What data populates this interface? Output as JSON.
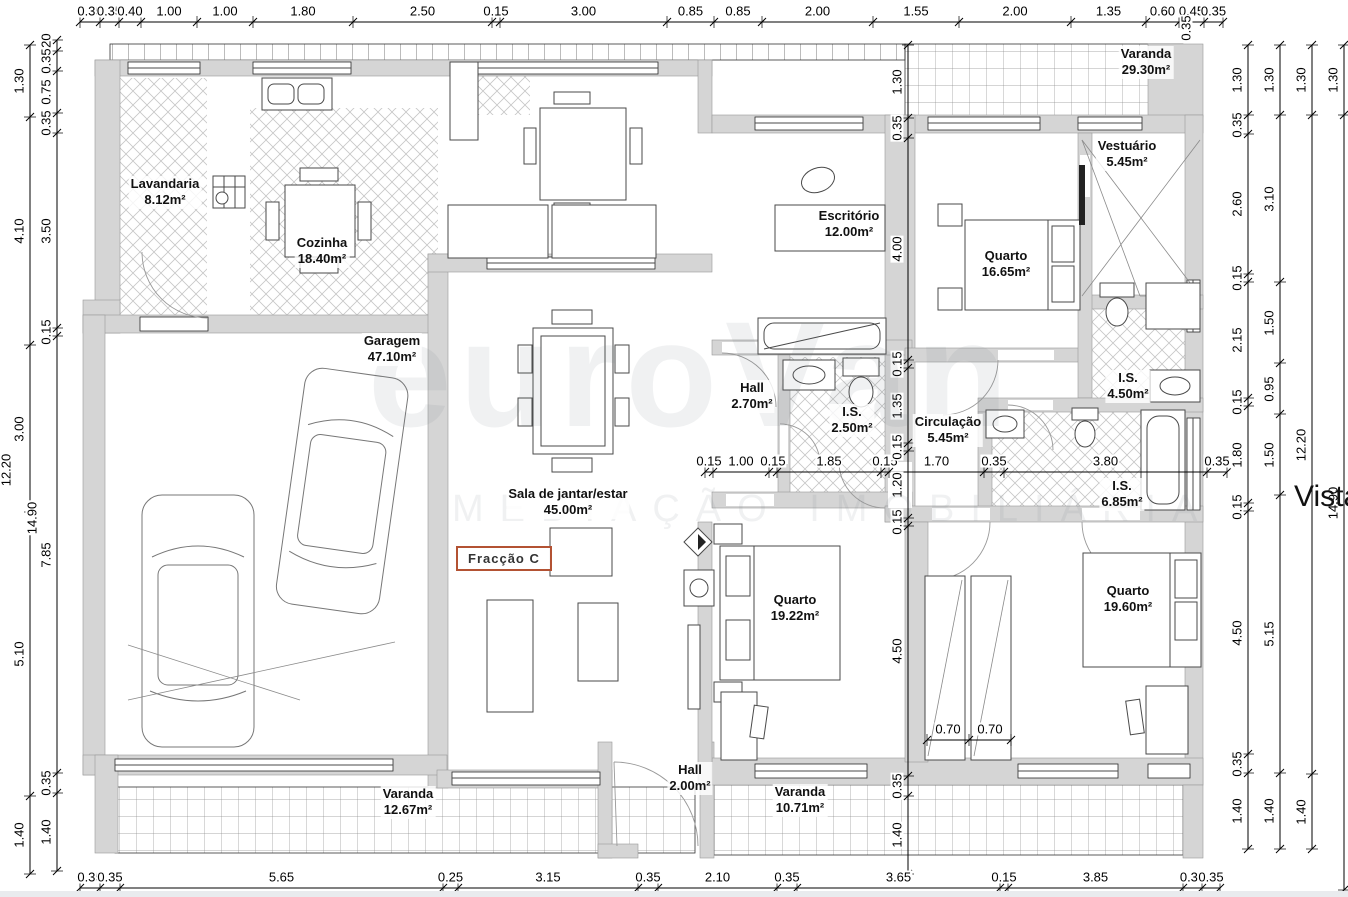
{
  "fraction_label": "Fracção C",
  "vista_label": "Vista",
  "watermark": {
    "line1": "euroVan",
    "line2": "MEDIAÇÃO IMOBILIÁRIA"
  },
  "rooms": [
    {
      "name": "Lavandaria",
      "area": "8.12m²"
    },
    {
      "name": "Cozinha",
      "area": "18.40m²"
    },
    {
      "name": "Garagem",
      "area": "47.10m²"
    },
    {
      "name": "Sala de jantar/estar",
      "area": "45.00m²"
    },
    {
      "name": "Escritório",
      "area": "12.00m²"
    },
    {
      "name": "Hall",
      "area": "2.70m²"
    },
    {
      "name": "I.S.",
      "area": "2.50m²"
    },
    {
      "name": "Circulação",
      "area": "5.45m²"
    },
    {
      "name": "Vestuário",
      "area": "5.45m²"
    },
    {
      "name": "Quarto",
      "area": "16.65m²"
    },
    {
      "name": "I.S.",
      "area": "4.50m²"
    },
    {
      "name": "I.S.",
      "area": "6.85m²"
    },
    {
      "name": "Quarto",
      "area": "19.22m²"
    },
    {
      "name": "Quarto",
      "area": "19.60m²"
    },
    {
      "name": "Hall",
      "area": "2.00m²"
    },
    {
      "name": "Varanda",
      "area": "29.30m²"
    },
    {
      "name": "Varanda",
      "area": "10.71m²"
    },
    {
      "name": "Varanda",
      "area": "12.67m²"
    }
  ],
  "dims": {
    "top": [
      "0.35",
      "0.35",
      "0.40",
      "1.00",
      "1.00",
      "1.80",
      "2.50",
      "0.15",
      "3.00",
      "0.85",
      "0.85",
      "2.00",
      "1.55",
      "2.00",
      "1.35",
      "0.60",
      "0.45",
      "0.35"
    ],
    "bottom": [
      "0.35",
      "0.35",
      "5.65",
      "0.25",
      "3.15",
      "0.35",
      "2.10",
      "0.35",
      "3.65",
      "0.15",
      "3.85",
      "0.35",
      "0.35"
    ],
    "middle": [
      "0.15",
      "1.00",
      "0.15",
      "1.85",
      "0.15",
      "1.70",
      "0.35",
      "3.80",
      "0.35"
    ],
    "center_v": [
      "1.30",
      "0.35",
      "4.00",
      "0.15",
      "1.35",
      "0.15",
      "1.20",
      "0.15",
      "4.50",
      "0.35",
      "1.40"
    ],
    "left_inner": [
      "0.20",
      "0.35",
      "0.75",
      "0.35",
      "3.50",
      "0.15",
      "7.85",
      "0.35",
      "1.40"
    ],
    "left_outer": [
      "1.30",
      "4.10",
      "3.00",
      "5.10",
      "1.40"
    ],
    "right_1": [
      "1.30",
      "0.35",
      "2.60",
      "0.15",
      "2.15",
      "0.15",
      "1.80",
      "0.15",
      "4.50",
      "0.35",
      "1.40"
    ],
    "right_2": [
      "1.30",
      "3.10",
      "1.50",
      "0.95",
      "1.50",
      "5.15",
      "1.40"
    ],
    "right_3": [
      "1.30",
      "12.20",
      "1.40"
    ],
    "right_4": [
      "1.30",
      "14.90"
    ],
    "wardrobe": [
      "0.70",
      "0.70"
    ],
    "extras": [
      "14.90",
      "12.20",
      "0.35"
    ]
  },
  "colors": {
    "wall": "#d5d5d5",
    "accent": "#b35233",
    "line": "#333333"
  }
}
